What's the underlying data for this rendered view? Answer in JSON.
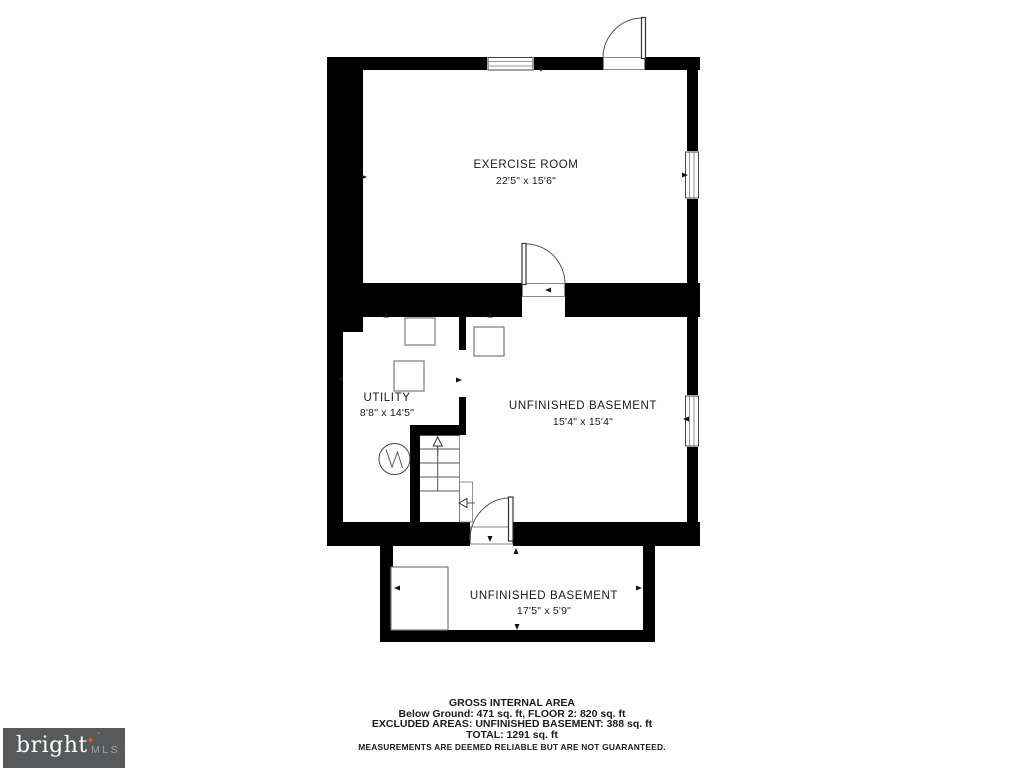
{
  "plan": {
    "rooms": [
      {
        "name": "EXERCISE ROOM",
        "dims": "22'5\" x 15'6\""
      },
      {
        "name": "UTILITY",
        "dims": "8'8\" x 14'5\""
      },
      {
        "name": "UNFINISHED BASEMENT",
        "dims": "15'4\" x 15'4\""
      },
      {
        "name": "UNFINISHED BASEMENT",
        "dims": "17'5\" x 5'9\""
      }
    ]
  },
  "footer": {
    "title": "GROSS INTERNAL AREA",
    "line1": "Below Ground: 471 sq. ft, FLOOR 2: 820 sq. ft",
    "line2": "EXCLUDED AREAS: UNFINISHED BASEMENT: 388 sq. ft",
    "line3": "TOTAL: 1291 sq. ft",
    "disclaimer": "MEASUREMENTS ARE DEEMED RELIABLE BUT ARE NOT GUARANTEED."
  },
  "logo": {
    "brand": "bright",
    "suffix": "MLS",
    "star": "✦",
    "tm": "™",
    "colors": {
      "bg": "#58595b",
      "brand": "#ffffff",
      "suffix": "#a0a2a5",
      "star": "#e0592a"
    }
  },
  "colors": {
    "wall": "#000000",
    "line": "#555555",
    "text": "#1a1a1a"
  }
}
